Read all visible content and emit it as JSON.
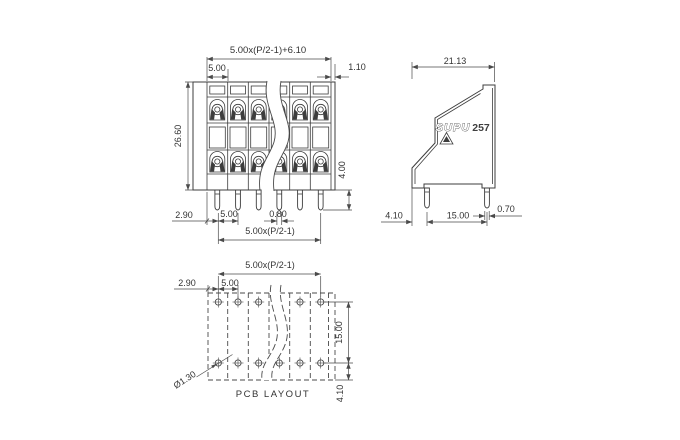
{
  "colors": {
    "background": "#ffffff",
    "line": "#3d3d3d",
    "dimension_line": "#4a4a4a",
    "text": "#333333"
  },
  "front_view": {
    "dim_overall_width": "5.00x(P/2-1)+6.10",
    "dim_pitch_top": "5.00",
    "dim_corner_margin": "1.10",
    "dim_body_height": "26.60",
    "dim_pin_length": "4.00",
    "dim_edge_to_pin": "2.90",
    "dim_pin_pitch": "5.00",
    "dim_pin_width": "0.80",
    "dim_pin_span": "5.00x(P/2-1)"
  },
  "side_view": {
    "dim_body_depth": "21.13",
    "brand": "SUPU",
    "series": "257",
    "dim_pin_offset": "4.10",
    "dim_row_pitch": "15.00",
    "dim_pin_width": "0.70"
  },
  "pcb_layout": {
    "caption": "PCB LAYOUT",
    "dim_hole_span": "5.00x(P/2-1)",
    "dim_edge_to_hole": "2.90",
    "dim_hole_pitch": "5.00",
    "dim_row_pitch": "15.00",
    "dim_bottom_offset": "4.10",
    "dim_hole_diameter": "Ø1.30"
  }
}
